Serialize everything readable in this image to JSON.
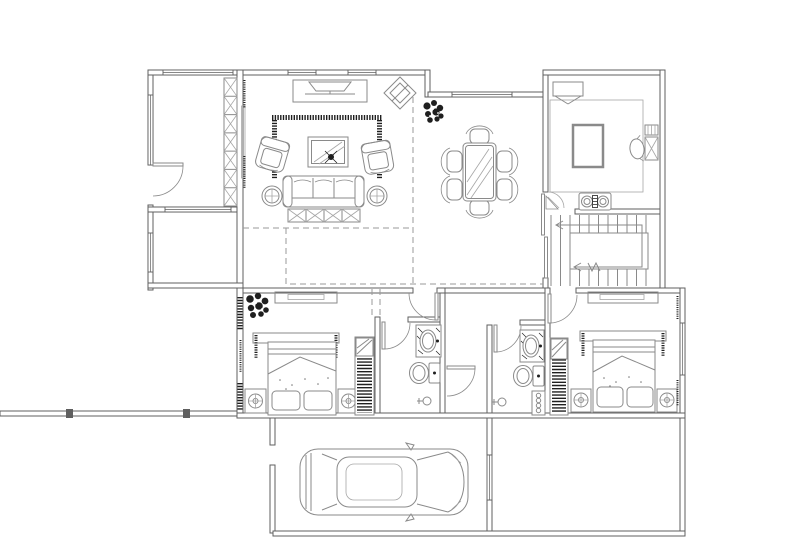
{
  "title": "Residential Floor Plan — CAD Drawing",
  "colors": {
    "background": "#ffffff",
    "wall": "#5f5f5f",
    "fur": "#8a8a8a",
    "light": "#a6a6a6",
    "dark": "#1f1f1f",
    "dash": "#9a9a9a"
  },
  "floor_plan": {
    "drawing_type": "architectural-plan",
    "visible_text": [],
    "rooms": [
      {
        "name": "study",
        "furniture": [
          "bookshelf-7-cells",
          "swing-door",
          "window-top",
          "window-left"
        ]
      },
      {
        "name": "lower-left-room",
        "furniture": []
      },
      {
        "name": "living-room",
        "furniture": [
          "tv-cabinet",
          "tv",
          "corner-stand-diamond",
          "area-rug-border",
          "coffee-table-glass",
          "armchair-left",
          "armchair-right",
          "sofa-3-seat",
          "round-side-table-left",
          "round-side-table-right",
          "console-x-cabinet",
          "plant"
        ]
      },
      {
        "name": "dining-room",
        "furniture": [
          "dining-table-glass",
          "chair-top",
          "chair-bottom",
          "chair-left-upper",
          "chair-left-lower",
          "chair-right-upper",
          "chair-right-lower"
        ]
      },
      {
        "name": "kitchen",
        "furniture": [
          "refrigerator",
          "island-counter",
          "gas-cooktop-2-burner",
          "corner-shelf",
          "side-table-x",
          "chair",
          "sliding-door"
        ]
      },
      {
        "name": "staircase",
        "furniture": [
          "treads",
          "direction-arrow-u-turn",
          "break-mark"
        ]
      },
      {
        "name": "bedroom-1",
        "furniture": [
          "plant",
          "dresser",
          "headboard",
          "double-bed",
          "foot-cushions",
          "nightstand-lamp-left",
          "nightstand-lamp-right",
          "wardrobe-striped"
        ]
      },
      {
        "name": "bathroom-1",
        "furniture": [
          "vanity-sink",
          "toilet",
          "floor-drain",
          "swing-door"
        ]
      },
      {
        "name": "hallway",
        "furniture": [
          "swing-door-suite-1",
          "swing-door-middle"
        ]
      },
      {
        "name": "bathroom-2",
        "furniture": [
          "vanity-sink",
          "toilet",
          "floor-drain",
          "shelf-column",
          "swing-door"
        ]
      },
      {
        "name": "bedroom-2",
        "furniture": [
          "dresser",
          "headboard",
          "double-bed",
          "foot-cushions",
          "nightstand-lamp-left",
          "nightstand-lamp-right",
          "wardrobe-striped",
          "swing-door",
          "window-right"
        ]
      },
      {
        "name": "garage",
        "furniture": [
          "car-top-view",
          "window-right",
          "side-opening"
        ]
      },
      {
        "name": "terrace-left",
        "furniture": [
          "boundary-wall",
          "column-post",
          "column-post"
        ]
      },
      {
        "name": "patio-bottom-right",
        "furniture": []
      }
    ],
    "annotations": [
      "dashed-void-boundary-lines",
      "illegible-dimension-squiggles",
      "dark-hatch-window-marks"
    ]
  }
}
